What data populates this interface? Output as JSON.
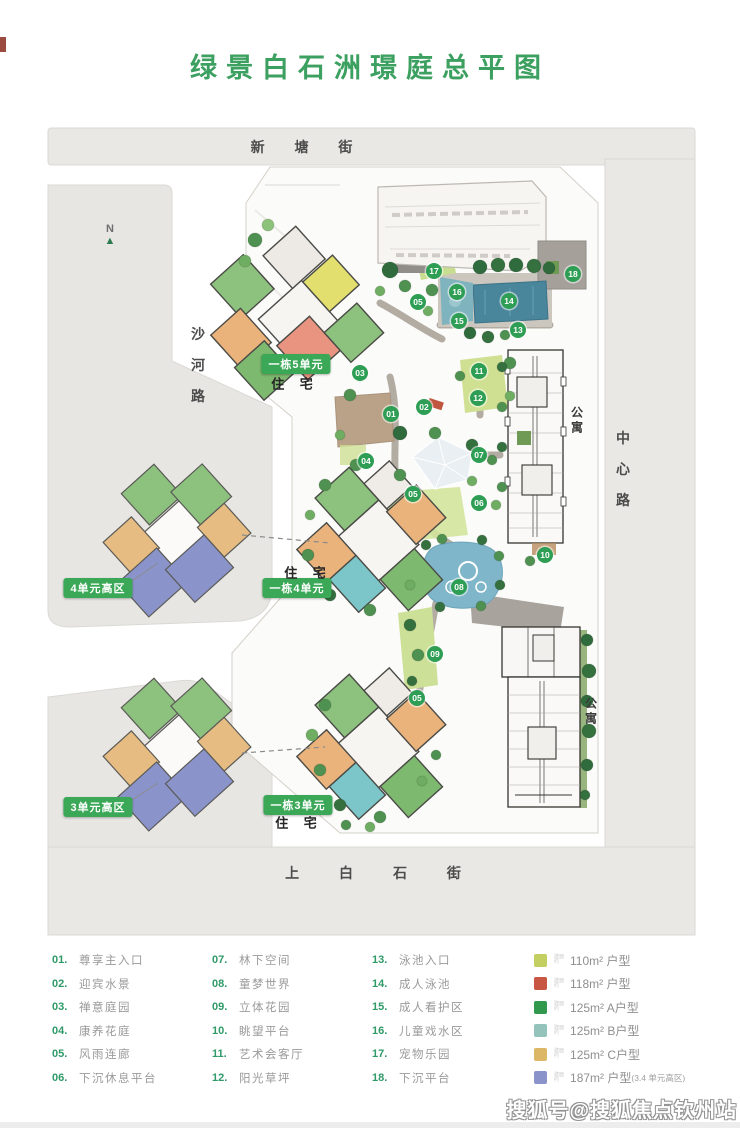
{
  "title": "绿景白石洲璟庭总平图",
  "map": {
    "roads": {
      "top": "新 塘 街",
      "left": "沙河路",
      "right": "中心路",
      "bottom": "上 白 石 街"
    },
    "compass_label": "N",
    "markers": [
      {
        "n": "01",
        "x": 351,
        "y": 299
      },
      {
        "n": "02",
        "x": 384,
        "y": 292
      },
      {
        "n": "03",
        "x": 320,
        "y": 258
      },
      {
        "n": "04",
        "x": 326,
        "y": 346
      },
      {
        "n": "05",
        "x": 378,
        "y": 187
      },
      {
        "n": "05",
        "x": 373,
        "y": 379
      },
      {
        "n": "05",
        "x": 377,
        "y": 583
      },
      {
        "n": "06",
        "x": 439,
        "y": 388
      },
      {
        "n": "07",
        "x": 439,
        "y": 340
      },
      {
        "n": "08",
        "x": 419,
        "y": 472
      },
      {
        "n": "09",
        "x": 395,
        "y": 539
      },
      {
        "n": "10",
        "x": 505,
        "y": 440
      },
      {
        "n": "11",
        "x": 439,
        "y": 256
      },
      {
        "n": "12",
        "x": 438,
        "y": 283
      },
      {
        "n": "13",
        "x": 478,
        "y": 215
      },
      {
        "n": "14",
        "x": 469,
        "y": 186
      },
      {
        "n": "15",
        "x": 419,
        "y": 206
      },
      {
        "n": "16",
        "x": 417,
        "y": 177
      },
      {
        "n": "17",
        "x": 394,
        "y": 156
      },
      {
        "n": "18",
        "x": 533,
        "y": 159
      }
    ],
    "green_labels": [
      {
        "text": "一栋5单元",
        "x": 256,
        "y": 249
      },
      {
        "text": "一栋4单元",
        "x": 257,
        "y": 473
      },
      {
        "text": "一栋3单元",
        "x": 258,
        "y": 690
      },
      {
        "text": "4单元高区",
        "x": 58,
        "y": 473
      },
      {
        "text": "3单元高区",
        "x": 58,
        "y": 692
      }
    ],
    "type_labels": [
      {
        "text": "住 宅",
        "x": 255,
        "y": 268
      },
      {
        "text": "住 宅",
        "x": 268,
        "y": 457
      },
      {
        "text": "住 宅",
        "x": 259,
        "y": 707
      }
    ],
    "apartment_labels": [
      {
        "text": "公寓",
        "x": 537,
        "y": 306
      },
      {
        "text": "公寓",
        "x": 551,
        "y": 597
      }
    ]
  },
  "legend": {
    "tiny_note": [
      "建面",
      "约"
    ],
    "columns": [
      [
        {
          "n": "01.",
          "t": "尊享主入口"
        },
        {
          "n": "02.",
          "t": "迎宾水景"
        },
        {
          "n": "03.",
          "t": "禅意庭园"
        },
        {
          "n": "04.",
          "t": "康养花庭"
        },
        {
          "n": "05.",
          "t": "风雨连廊"
        },
        {
          "n": "06.",
          "t": "下沉休息平台"
        }
      ],
      [
        {
          "n": "07.",
          "t": "林下空间"
        },
        {
          "n": "08.",
          "t": "童梦世界"
        },
        {
          "n": "09.",
          "t": "立体花园"
        },
        {
          "n": "10.",
          "t": "眺望平台"
        },
        {
          "n": "11.",
          "t": "艺术会客厅"
        },
        {
          "n": "12.",
          "t": "阳光草坪"
        }
      ],
      [
        {
          "n": "13.",
          "t": "泳池入口"
        },
        {
          "n": "14.",
          "t": "成人泳池"
        },
        {
          "n": "15.",
          "t": "成人看护区"
        },
        {
          "n": "16.",
          "t": "儿童戏水区"
        },
        {
          "n": "17.",
          "t": "宠物乐园"
        },
        {
          "n": "18.",
          "t": "下沉平台"
        }
      ]
    ]
  },
  "unit_types": [
    {
      "color": "#c3cf60",
      "label": "110m² 户型",
      "note": ""
    },
    {
      "color": "#c75642",
      "label": "118m² 户型",
      "note": ""
    },
    {
      "color": "#31984d",
      "label": "125m² A户型",
      "note": ""
    },
    {
      "color": "#93c3bb",
      "label": "125m² B户型",
      "note": ""
    },
    {
      "color": "#dcb766",
      "label": "125m² C户型",
      "note": ""
    },
    {
      "color": "#8b94ca",
      "label": "187m² 户型",
      "note": "(3.4 单元高区)"
    }
  ],
  "watermark": "搜狐号@搜狐焦点钦州站"
}
